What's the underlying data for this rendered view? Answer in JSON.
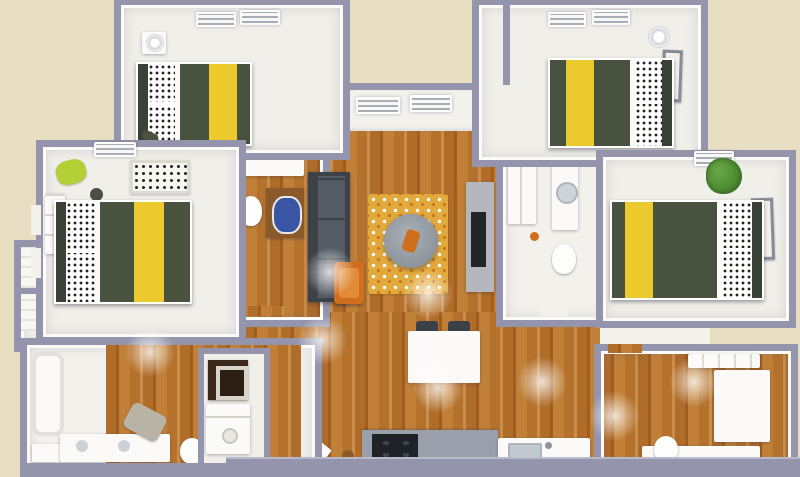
{
  "title": "3D apartment floor plan render, top-down view",
  "colors": {
    "background": "#e8dfc3",
    "wall": "#9495ac",
    "wall_light": "#b9bac9",
    "interior_white": "#f2f1ec",
    "carpet": "#f1efe9",
    "fixture_white": "#fbfaf8",
    "wood_a": "#b06c29",
    "wood_b": "#c08038",
    "wood_c": "#a15d1f",
    "wood_d": "#c98e4b",
    "comforter": "#49523f",
    "comforter_dark": "#3a4136",
    "stripe_yellow": "#ecc92c",
    "pillow_dot": "#23231f",
    "sofa": "#3c4248",
    "sofa_seat": "#545b64",
    "accent_orange": "#cf6e1c",
    "accent_orange_light": "#e28a36",
    "rug_gold": "#e2a93c",
    "table_gray": "#8d949c",
    "tv_dark": "#22252a",
    "counter_gray": "#9aa0ab",
    "appliance_dark": "#1f2327",
    "vanity_brown": "#8a5a2b",
    "sink_blue": "#3b55a5",
    "plant_green": "#4c8a33",
    "lime_green": "#b5cf36",
    "towel_gray": "#b9b3a6",
    "glow": "rgba(255,255,255,0.78)"
  },
  "floor_plan": {
    "type": "3d-floor-plan",
    "view": "top-down 3D dollhouse render",
    "bedroom_count": 4,
    "bathroom_count": 4,
    "rooms": [
      {
        "id": "bedroom-top-left",
        "furniture": [
          "double-bed-yellow-stripe",
          "nightstand",
          "table-lamp",
          "wall-vents"
        ]
      },
      {
        "id": "bedroom-top-right",
        "furniture": [
          "double-bed-yellow-stripe",
          "table-lamp",
          "wall-art",
          "closet",
          "wall-vents"
        ]
      },
      {
        "id": "bedroom-mid-left",
        "furniture": [
          "double-bed-yellow-stripe",
          "dresser",
          "lime-accent-chair",
          "stool",
          "patterned-rug",
          "wall-vent"
        ]
      },
      {
        "id": "bedroom-mid-right",
        "furniture": [
          "double-bed-yellow-stripe",
          "potted-plant",
          "wall-art",
          "wall-vent"
        ]
      },
      {
        "id": "living-room",
        "furniture": [
          "charcoal-sectional-sofa",
          "orange-accent-chair",
          "gold-area-rug",
          "round-coffee-table",
          "tv-console",
          "tv"
        ]
      },
      {
        "id": "dining-area",
        "furniture": [
          "white-island-table",
          "two-dark-chairs"
        ]
      },
      {
        "id": "kitchen",
        "furniture": [
          "gray-counter",
          "dark-range",
          "white-counter",
          "sink"
        ]
      },
      {
        "id": "hall-bath-left",
        "furniture": [
          "linen-closet",
          "toilet",
          "wood-vanity-blue-sink"
        ]
      },
      {
        "id": "hall-bath-right",
        "furniture": [
          "wardrobe",
          "sink-counter",
          "toilet"
        ]
      },
      {
        "id": "bathroom-bottom-left",
        "furniture": [
          "bathtub",
          "shower",
          "double-sink-vanity",
          "towel",
          "toilet"
        ]
      },
      {
        "id": "laundry-closet",
        "furniture": [
          "stacked-washer-dryer"
        ]
      },
      {
        "id": "closets-left",
        "furniture": [
          "shelving-units"
        ]
      },
      {
        "id": "bathroom-bottom-right",
        "furniture": [
          "shelf",
          "corner-counter",
          "vanity",
          "toilet"
        ]
      }
    ],
    "floor_materials": {
      "bedrooms": "light carpet",
      "living_kitchen_baths": "warm wood planks"
    },
    "wall_color_description": "gray-lavender walls on beige background"
  }
}
